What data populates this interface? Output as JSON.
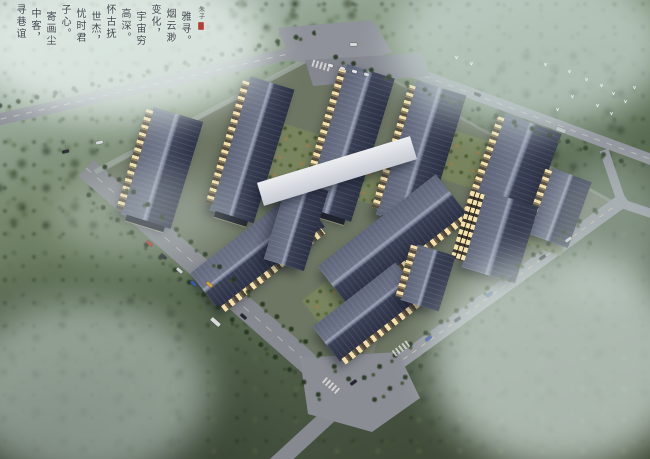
{
  "calligraphy": {
    "columns": [
      "雅寻。",
      "烟云渺",
      "变化，",
      "宇宙穷",
      "高深。",
      "怀古抚",
      "世杰，",
      "忧时君",
      "子心。",
      "寄画尘",
      "中客，",
      "寻巷谊"
    ],
    "signature": "朱子",
    "seal_color": "#b23f36",
    "ink_color": "#2e343b"
  },
  "palette": {
    "roof_dark": "#2c3145",
    "roof_light": "#6d7488",
    "roof_ridge": "#9ba2b5",
    "facade": "#d6cdbb",
    "window_glow": "#f4e0a8",
    "road": "#8f929a",
    "campus_ground": "#6d7663",
    "courtyard_green": "#78845e",
    "autumn_tree": "#c1763c",
    "forest_green": "#45523f",
    "mist": "#dfe9e6",
    "bird_white": "#f4f8f6"
  }
}
